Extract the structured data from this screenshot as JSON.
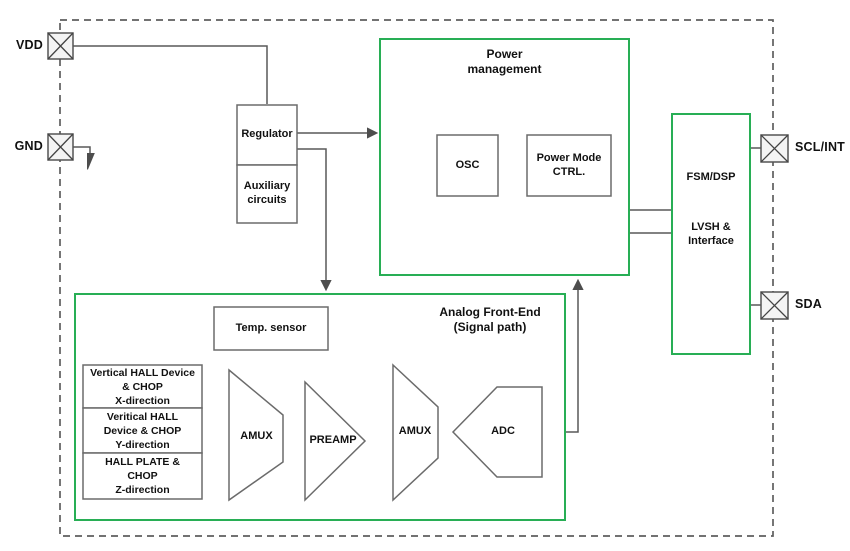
{
  "colors": {
    "green": "#28ae55",
    "wire": "#595959",
    "box": "#6b6b6b",
    "ink": "#111111",
    "pin-fill": "#f4f4f4",
    "bg": "#ffffff"
  },
  "pins": {
    "vdd": "VDD",
    "gnd": "GND",
    "scl": "SCL/INT",
    "sda": "SDA"
  },
  "blocks": {
    "regulator": "Regulator",
    "auxiliary": "Auxiliary\ncircuits",
    "power_management": {
      "title": "Power\nmanagement",
      "osc": "OSC",
      "power_mode_ctrl": "Power Mode\nCTRL."
    },
    "fsm": {
      "fsm_dsp": "FSM/DSP",
      "lvsh": "LVSH &\nInterface"
    },
    "afe": {
      "title": "Analog Front-End\n(Signal path)",
      "temp_sensor": "Temp. sensor",
      "hall_x": "Vertical HALL Device\n& CHOP\nX-direction",
      "hall_y": "Veritical HALL\nDevice & CHOP\nY-direction",
      "hall_z": "HALL PLATE &\nCHOP\nZ-direction",
      "amux1": "AMUX",
      "preamp": "PREAMP",
      "amux2": "AMUX",
      "adc": "ADC"
    }
  }
}
